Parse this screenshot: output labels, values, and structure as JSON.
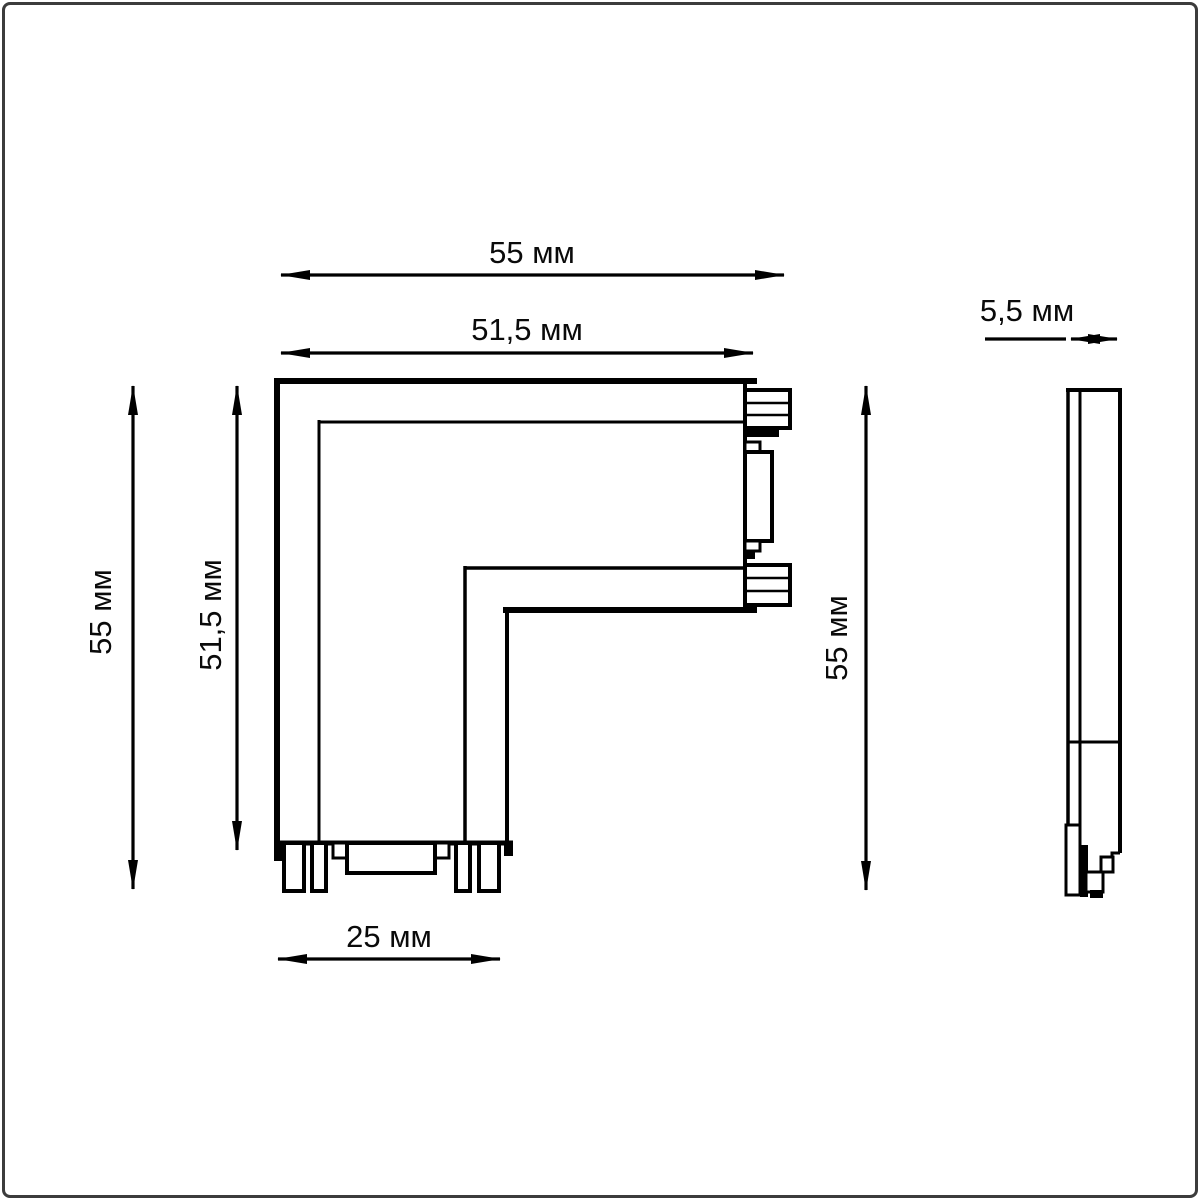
{
  "page": {
    "background": "#ffffff",
    "border_color": "#3c3c3c",
    "line_color": "#000000"
  },
  "drawing": {
    "unit": "мм",
    "dimensions": {
      "top_overall_width": {
        "label": "55 мм",
        "value": 55
      },
      "top_inner_width": {
        "label": "51,5 мм",
        "value": 51.5
      },
      "left_overall_height": {
        "label": "55 мм",
        "value": 55
      },
      "left_inner_height": {
        "label": "51,5 мм",
        "value": 51.5
      },
      "right_overall_height": {
        "label": "55 мм",
        "value": 55
      },
      "bottom_leg_width": {
        "label": "25 мм",
        "value": 25
      },
      "side_profile_depth": {
        "label": "5,5 мм",
        "value": 5.5
      }
    }
  }
}
